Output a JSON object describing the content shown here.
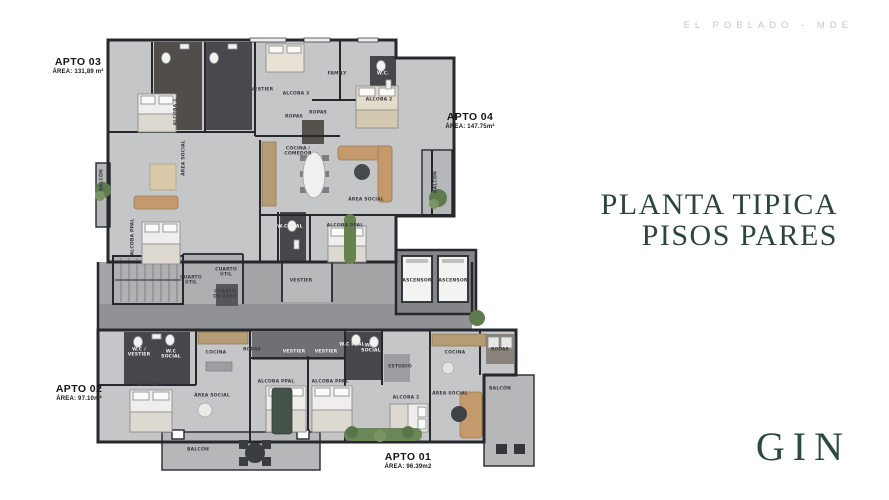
{
  "header": {
    "location": "EL POBLADO - MDE"
  },
  "title": {
    "line1": "PLANTA TIPICA",
    "line2": "PISOS PARES"
  },
  "brand": {
    "logo": "GIN"
  },
  "colors": {
    "accent_green": "#2c463e",
    "muted_gray": "#c7c7c7",
    "plan_floor": "#c5c6c7",
    "plan_wall": "#26282d",
    "corridor": "#a4a5a7"
  },
  "apartments": [
    {
      "name": "APTO 03",
      "area": "ÁREA: 131,89 m²",
      "x": 78,
      "y": 56
    },
    {
      "name": "APTO 04",
      "area": "ÁREA: 147.75m²",
      "x": 470,
      "y": 111
    },
    {
      "name": "APTO 02",
      "area": "ÁREA: 97.10m²",
      "x": 79,
      "y": 383
    },
    {
      "name": "APTO 01",
      "area": "ÁREA: 96.39m2",
      "x": 408,
      "y": 451
    }
  ],
  "rooms": [
    {
      "label": "VESTIER",
      "x": 262,
      "y": 90
    },
    {
      "label": "ALCOBA 3",
      "x": 296,
      "y": 94
    },
    {
      "label": "FAMILY",
      "x": 337,
      "y": 74
    },
    {
      "label": "W.C.",
      "x": 383,
      "y": 74,
      "light": true
    },
    {
      "label": "ROPAS",
      "x": 294,
      "y": 117
    },
    {
      "label": "ROPAS",
      "x": 318,
      "y": 113
    },
    {
      "label": "ALCOBA 2",
      "x": 176,
      "y": 112,
      "vertical": true
    },
    {
      "label": "ÁREA SOCIAL",
      "x": 184,
      "y": 158,
      "vertical": true
    },
    {
      "label": "ALCOBA PPAL",
      "x": 133,
      "y": 237,
      "vertical": true
    },
    {
      "label": "BALCÓN",
      "x": 102,
      "y": 180,
      "vertical": true
    },
    {
      "label": "ALCOBA 2",
      "x": 379,
      "y": 100
    },
    {
      "label": "COCINA /\nCOMEDOR",
      "x": 298,
      "y": 152
    },
    {
      "label": "ÁREA SOCIAL",
      "x": 366,
      "y": 200
    },
    {
      "label": "BALCÓN",
      "x": 436,
      "y": 182,
      "vertical": true
    },
    {
      "label": "W.C PPAL",
      "x": 290,
      "y": 227,
      "light": true
    },
    {
      "label": "ALCOBA PPAL",
      "x": 345,
      "y": 226
    },
    {
      "label": "VESTIER",
      "x": 301,
      "y": 281
    },
    {
      "label": "CUARTO\nÚTIL",
      "x": 191,
      "y": 281
    },
    {
      "label": "CUARTO\nÚTIL",
      "x": 226,
      "y": 273
    },
    {
      "label": "CUARTO\nDE ASEO",
      "x": 225,
      "y": 295
    },
    {
      "label": "ASCENSOR",
      "x": 417,
      "y": 281
    },
    {
      "label": "ASCENSOR",
      "x": 453,
      "y": 281
    },
    {
      "label": "W.C /\nVESTIER",
      "x": 139,
      "y": 353,
      "light": true
    },
    {
      "label": "W.C\nSOCIAL",
      "x": 171,
      "y": 355,
      "light": true
    },
    {
      "label": "COCINA",
      "x": 216,
      "y": 353
    },
    {
      "label": "ROPAS",
      "x": 252,
      "y": 350
    },
    {
      "label": "ALCOBA 2",
      "x": 151,
      "y": 385
    },
    {
      "label": "ÁREA SOCIAL",
      "x": 212,
      "y": 396
    },
    {
      "label": "BALCÓN",
      "x": 198,
      "y": 450
    },
    {
      "label": "W.C PPAL",
      "x": 352,
      "y": 345,
      "light": true
    },
    {
      "label": "VESTIER",
      "x": 294,
      "y": 352,
      "light": true
    },
    {
      "label": "VESTIER",
      "x": 326,
      "y": 352,
      "light": true
    },
    {
      "label": "W.C.\nSOCIAL",
      "x": 371,
      "y": 349,
      "light": true
    },
    {
      "label": "ALCOBA PPAL",
      "x": 276,
      "y": 382
    },
    {
      "label": "ALCOBA PPAL",
      "x": 330,
      "y": 382
    },
    {
      "label": "ESTUDIO",
      "x": 400,
      "y": 367
    },
    {
      "label": "ALCOBA 2",
      "x": 406,
      "y": 398
    },
    {
      "label": "COCINA",
      "x": 455,
      "y": 353
    },
    {
      "label": "ÁREA SOCIAL",
      "x": 450,
      "y": 394
    },
    {
      "label": "ROPAS",
      "x": 500,
      "y": 350
    },
    {
      "label": "BALCÓN",
      "x": 500,
      "y": 389
    }
  ]
}
